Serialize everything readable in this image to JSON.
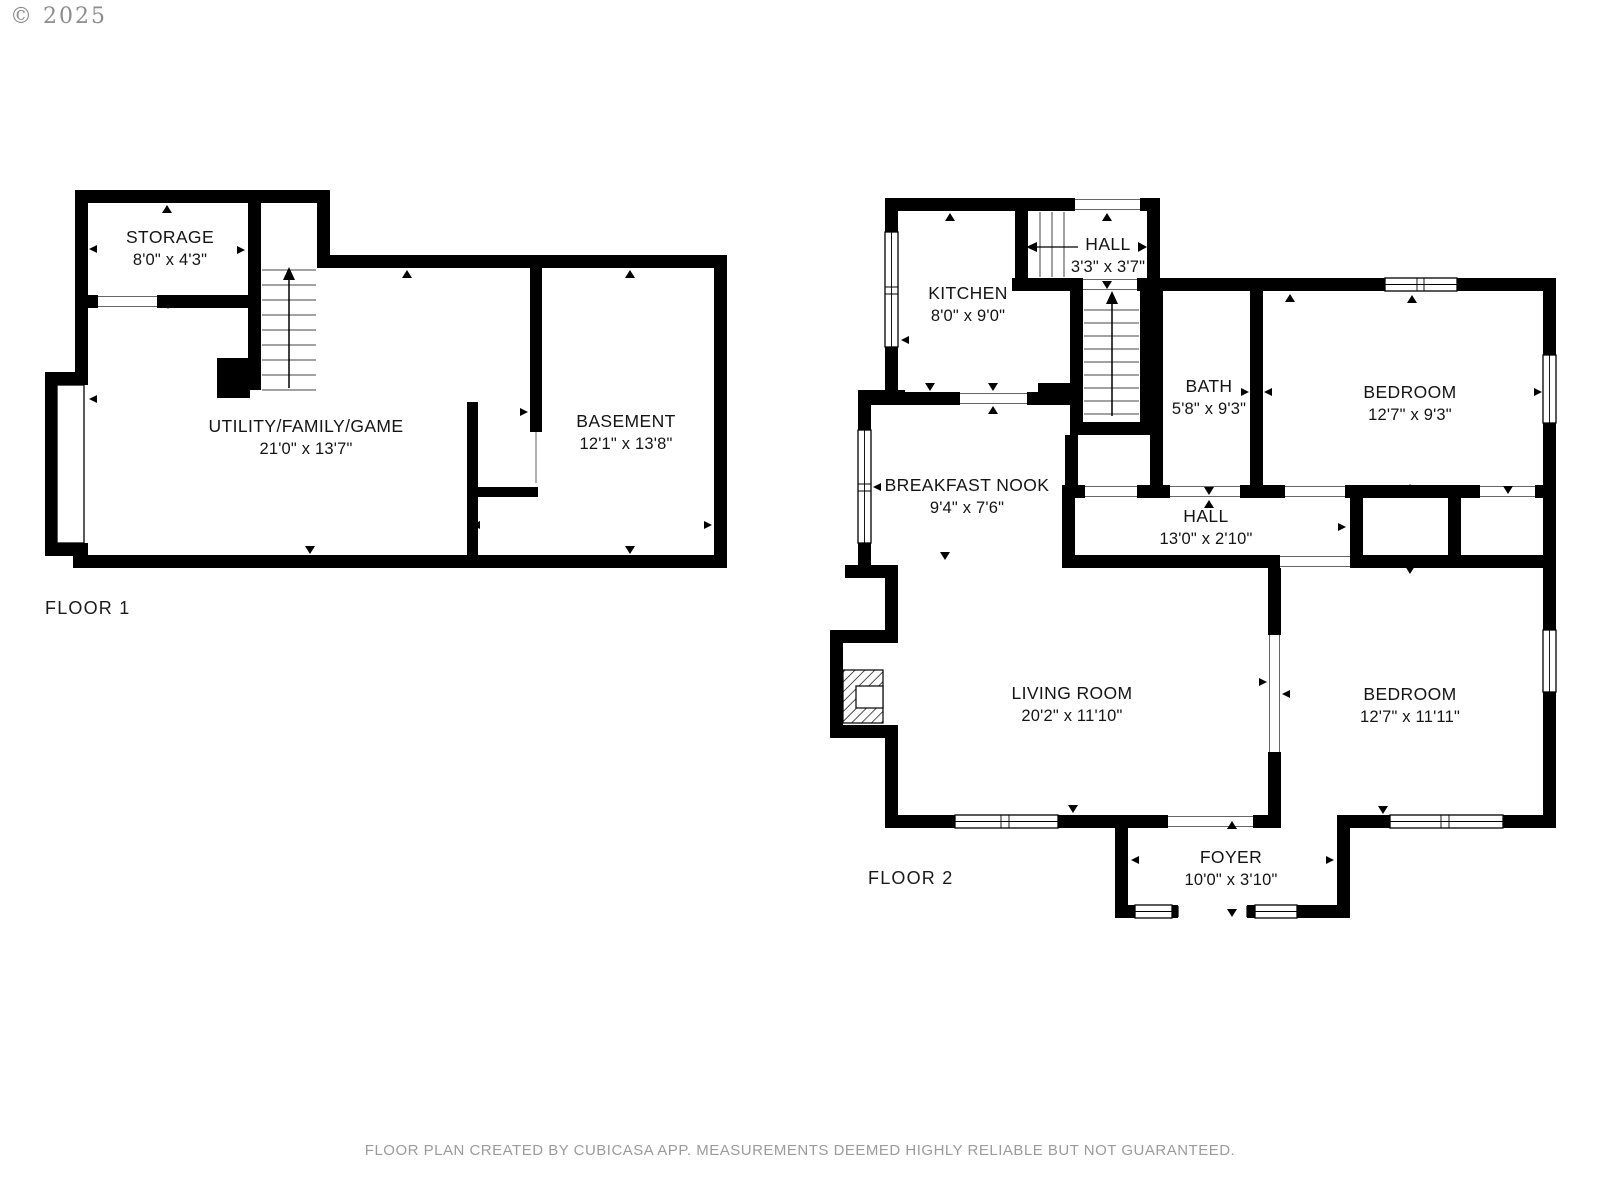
{
  "copyright": "© 2025",
  "footer": "FLOOR PLAN CREATED BY CUBICASA APP. MEASUREMENTS DEEMED HIGHLY RELIABLE BUT NOT GUARANTEED.",
  "colors": {
    "wall": "#000000",
    "text": "#141414",
    "muted": "#9b9b9b"
  },
  "floor1": {
    "label": "FLOOR 1",
    "rooms": {
      "storage": {
        "name": "STORAGE",
        "dims": "8'0\" x 4'3\""
      },
      "utility": {
        "name": "UTILITY/FAMILY/GAME",
        "dims": "21'0\" x 13'7\""
      },
      "basement": {
        "name": "BASEMENT",
        "dims": "12'1\" x 13'8\""
      }
    }
  },
  "floor2": {
    "label": "FLOOR 2",
    "rooms": {
      "kitchen": {
        "name": "KITCHEN",
        "dims": "8'0\" x 9'0\""
      },
      "hall_upper": {
        "name": "HALL",
        "dims": "3'3\" x 3'7\""
      },
      "bath": {
        "name": "BATH",
        "dims": "5'8\" x 9'3\""
      },
      "bedroom_top": {
        "name": "BEDROOM",
        "dims": "12'7\" x 9'3\""
      },
      "breakfast_nook": {
        "name": "BREAKFAST NOOK",
        "dims": "9'4\" x 7'6\""
      },
      "hall_main": {
        "name": "HALL",
        "dims": "13'0\" x 2'10\""
      },
      "living_room": {
        "name": "LIVING ROOM",
        "dims": "20'2\" x 11'10\""
      },
      "bedroom_bottom": {
        "name": "BEDROOM",
        "dims": "12'7\" x 11'11\""
      },
      "foyer": {
        "name": "FOYER",
        "dims": "10'0\" x 3'10\""
      }
    }
  }
}
